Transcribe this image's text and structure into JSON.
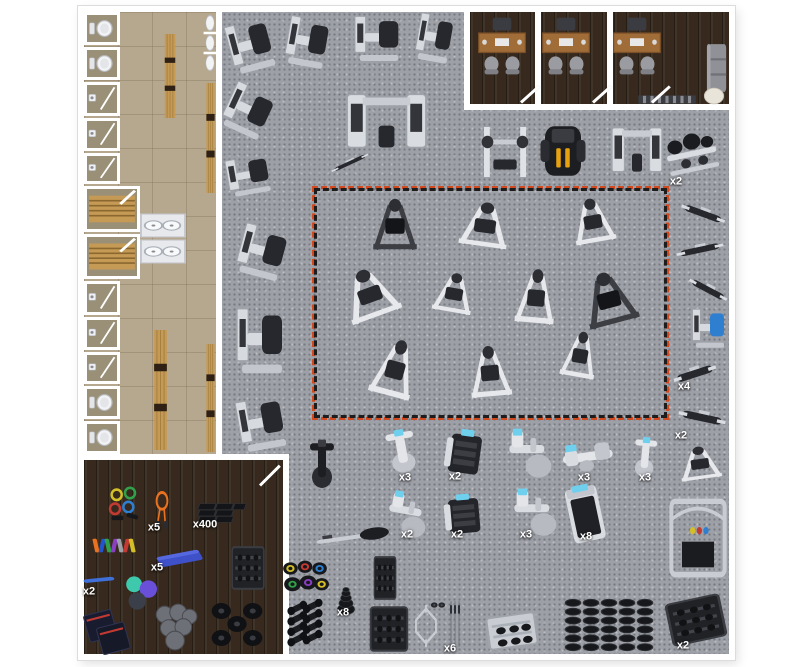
{
  "title": "gym-facility-floor-plan",
  "colors": {
    "wall": "#ffffff",
    "gym_floor": "#9da0a7",
    "locker_floor": "#b5a88e",
    "wood_floor": "#37291e",
    "red_dash": "#d14a1f",
    "red_dash_alt": "#1d1d1d",
    "label_text": "#ffffff",
    "machine_light": "#dfe2e7",
    "machine_dark": "#26282d",
    "cardio_screen_blue": "#6fd0ee",
    "bench_wood": "#c59a55",
    "rope_orange": "#e8721f",
    "yoga_mat_blue": "#3f51c9",
    "desk_wood": "#a06c38"
  },
  "locker": {
    "stalls": [
      {
        "name": "toilet-stall",
        "f": "toilet",
        "y": 12,
        "h": 33,
        "w": 36
      },
      {
        "name": "toilet-stall",
        "f": "toilet",
        "y": 47,
        "h": 33,
        "w": 36
      },
      {
        "name": "shower-stall",
        "f": "shower",
        "y": 82,
        "h": 34,
        "w": 36
      },
      {
        "name": "shower-stall",
        "f": "shower",
        "y": 118,
        "h": 33,
        "w": 36
      },
      {
        "name": "shower-stall",
        "f": "shower",
        "y": 153,
        "h": 31,
        "w": 36
      },
      {
        "name": "sauna-room",
        "f": "sauna",
        "y": 186,
        "h": 46,
        "w": 56
      },
      {
        "name": "sauna-room",
        "f": "sauna",
        "y": 234,
        "h": 45,
        "w": 56
      },
      {
        "name": "shower-stall",
        "f": "shower",
        "y": 281,
        "h": 34,
        "w": 36
      },
      {
        "name": "shower-stall",
        "f": "shower",
        "y": 317,
        "h": 33,
        "w": 36
      },
      {
        "name": "shower-stall",
        "f": "shower",
        "y": 352,
        "h": 32,
        "w": 36
      },
      {
        "name": "toilet-stall",
        "f": "toilet",
        "y": 386,
        "h": 33,
        "w": 36
      },
      {
        "name": "toilet-stall",
        "f": "toilet",
        "y": 421,
        "h": 33,
        "w": 36
      }
    ]
  },
  "fixtures": [
    {
      "name": "urinal-row",
      "type": "urinals",
      "x": 210,
      "y": 43,
      "w": 14,
      "h": 60
    },
    {
      "name": "locker-bench",
      "type": "woodbench",
      "x": 170,
      "y": 76,
      "w": 14,
      "h": 84
    },
    {
      "name": "locker-bench",
      "type": "woodbench",
      "x": 160,
      "y": 390,
      "w": 17,
      "h": 120
    },
    {
      "name": "wall-bench",
      "type": "woodbench",
      "x": 210,
      "y": 138,
      "w": 11,
      "h": 110
    },
    {
      "name": "wall-bench",
      "type": "woodbench",
      "x": 210,
      "y": 398,
      "w": 11,
      "h": 108
    },
    {
      "name": "sink-counter",
      "type": "sink",
      "x": 163,
      "y": 225,
      "w": 46,
      "h": 25
    },
    {
      "name": "sink-counter",
      "type": "sink",
      "x": 163,
      "y": 251,
      "w": 46,
      "h": 25
    },
    {
      "name": "office-desk-set",
      "type": "desk",
      "x": 502,
      "y": 46,
      "w": 56,
      "h": 62
    },
    {
      "name": "office-desk-set",
      "type": "desk",
      "x": 566,
      "y": 46,
      "w": 56,
      "h": 62
    },
    {
      "name": "office-desk-set",
      "type": "desk",
      "x": 637,
      "y": 46,
      "w": 56,
      "h": 62
    },
    {
      "name": "office-sofa",
      "type": "sofa",
      "x": 717,
      "y": 68,
      "w": 22,
      "h": 52
    },
    {
      "name": "office-round-table",
      "type": "roundtable",
      "x": 714,
      "y": 96,
      "w": 22,
      "h": 18
    },
    {
      "name": "radiator-vent",
      "type": "radiator",
      "x": 667,
      "y": 99,
      "w": 60,
      "h": 11
    }
  ],
  "equipment": [
    {
      "name": "pec-fly-machine",
      "type": "sel",
      "x": 252,
      "y": 45,
      "w": 54,
      "h": 64,
      "rot": -15
    },
    {
      "name": "leg-press-machine",
      "type": "sel",
      "x": 309,
      "y": 42,
      "w": 52,
      "h": 62,
      "rot": 10
    },
    {
      "name": "chest-press-machine",
      "type": "sel",
      "x": 379,
      "y": 38,
      "w": 58,
      "h": 58,
      "rot": 0
    },
    {
      "name": "lat-pulldown-tower",
      "type": "sel",
      "x": 436,
      "y": 38,
      "w": 44,
      "h": 60,
      "rot": 10
    },
    {
      "name": "leg-curl-machine",
      "type": "sel",
      "x": 250,
      "y": 111,
      "w": 56,
      "h": 60,
      "rot": 25
    },
    {
      "name": "multi-station-jungle",
      "type": "crossover",
      "x": 386,
      "y": 122,
      "w": 95,
      "h": 75,
      "rot": 0
    },
    {
      "name": "training-bench",
      "type": "bench",
      "x": 350,
      "y": 163,
      "w": 44,
      "h": 16,
      "rot": -25
    },
    {
      "name": "preacher-curl-machine",
      "type": "sel",
      "x": 250,
      "y": 175,
      "w": 54,
      "h": 48,
      "rot": -10
    },
    {
      "name": "shoulder-press-machine",
      "type": "sel",
      "x": 264,
      "y": 252,
      "w": 58,
      "h": 64,
      "rot": 15
    },
    {
      "name": "dip-chin-assist-tower",
      "type": "sel",
      "x": 262,
      "y": 340,
      "w": 60,
      "h": 84,
      "rot": 0
    },
    {
      "name": "glute-extension-machine",
      "type": "sel",
      "x": 263,
      "y": 423,
      "w": 58,
      "h": 66,
      "rot": -10
    },
    {
      "name": "smith-machine",
      "type": "smith",
      "x": 505,
      "y": 152,
      "w": 56,
      "h": 60,
      "rot": 0
    },
    {
      "name": "functional-trainer",
      "type": "darkft",
      "x": 563,
      "y": 151,
      "w": 54,
      "h": 66,
      "rot": 0
    },
    {
      "name": "cable-crossover-machine",
      "type": "crossover",
      "x": 637,
      "y": 151,
      "w": 60,
      "h": 62,
      "rot": 0
    },
    {
      "name": "barbell-plate-rack",
      "type": "rack2",
      "x": 692,
      "y": 155,
      "w": 60,
      "h": 55,
      "rot": -12,
      "label": "x2",
      "labelPos": [
        676,
        182
      ]
    },
    {
      "name": "preacher-bench",
      "type": "bench",
      "x": 703,
      "y": 214,
      "w": 50,
      "h": 28,
      "rot": 20
    },
    {
      "name": "hyperextension-bench",
      "type": "bench",
      "x": 700,
      "y": 250,
      "w": 52,
      "h": 26,
      "rot": -12
    },
    {
      "name": "ab-crunch-bench",
      "type": "bench",
      "x": 708,
      "y": 290,
      "w": 46,
      "h": 26,
      "rot": 28
    },
    {
      "name": "leg-raise-tower",
      "type": "sel",
      "x": 710,
      "y": 328,
      "w": 42,
      "h": 50,
      "rot": 0,
      "accent": "#2f7fd1"
    },
    {
      "name": "adjustable-bench",
      "type": "bench",
      "x": 695,
      "y": 374,
      "w": 48,
      "h": 32,
      "rot": -18,
      "label": "x4",
      "labelPos": [
        684,
        387
      ]
    },
    {
      "name": "flat-bench",
      "type": "bench",
      "x": 702,
      "y": 418,
      "w": 52,
      "h": 32,
      "rot": 12,
      "label": "x2",
      "labelPos": [
        681,
        436
      ]
    },
    {
      "name": "bench-press-station",
      "type": "plate",
      "x": 700,
      "y": 464,
      "w": 54,
      "h": 40,
      "rot": -8
    },
    {
      "name": "v-squat-machine",
      "type": "plate",
      "x": 395,
      "y": 226,
      "w": 58,
      "h": 62,
      "rot": 0,
      "dark": true
    },
    {
      "name": "glute-ham-machine",
      "type": "plate",
      "x": 485,
      "y": 226,
      "w": 64,
      "h": 54,
      "rot": 8
    },
    {
      "name": "t-bar-row-machine",
      "type": "plate",
      "x": 593,
      "y": 222,
      "w": 54,
      "h": 54,
      "rot": -10
    },
    {
      "name": "linear-leg-press",
      "type": "plate",
      "x": 370,
      "y": 295,
      "w": 70,
      "h": 60,
      "rot": -20
    },
    {
      "name": "iso-lateral-press",
      "type": "plate",
      "x": 454,
      "y": 294,
      "w": 52,
      "h": 48,
      "rot": 10
    },
    {
      "name": "seated-dip-machine",
      "type": "plate",
      "x": 536,
      "y": 298,
      "w": 52,
      "h": 66,
      "rot": 5
    },
    {
      "name": "hack-squat-machine",
      "type": "plate",
      "x": 609,
      "y": 300,
      "w": 68,
      "h": 64,
      "rot": -15,
      "dark": true
    },
    {
      "name": "incline-press-machine",
      "type": "plate",
      "x": 395,
      "y": 370,
      "w": 56,
      "h": 70,
      "rot": 15
    },
    {
      "name": "seated-row-machine",
      "type": "plate",
      "x": 490,
      "y": 373,
      "w": 54,
      "h": 62,
      "rot": -5
    },
    {
      "name": "glute-kickback-machine",
      "type": "plate",
      "x": 580,
      "y": 356,
      "w": 46,
      "h": 56,
      "rot": 10
    },
    {
      "name": "air-bike",
      "type": "bike",
      "x": 322,
      "y": 465,
      "w": 48,
      "h": 58,
      "rot": 0,
      "dark": true
    },
    {
      "name": "spin-bike",
      "type": "bike",
      "x": 402,
      "y": 452,
      "w": 56,
      "h": 52,
      "rot": -10,
      "label": "x3",
      "labelPos": [
        405,
        478
      ]
    },
    {
      "name": "stair-climber",
      "type": "climber",
      "x": 465,
      "y": 453,
      "w": 52,
      "h": 54,
      "rot": 8,
      "label": "x2",
      "labelPos": [
        455,
        477
      ]
    },
    {
      "name": "elliptical-trainer",
      "type": "elliptical",
      "x": 528,
      "y": 452,
      "w": 56,
      "h": 56,
      "rot": 0
    },
    {
      "name": "recumbent-bike",
      "type": "recumbent",
      "x": 588,
      "y": 458,
      "w": 60,
      "h": 46,
      "rot": -8,
      "label": "x3",
      "labelPos": [
        584,
        478
      ]
    },
    {
      "name": "upright-bike",
      "type": "bike",
      "x": 645,
      "y": 458,
      "w": 44,
      "h": 48,
      "rot": 5,
      "label": "x3",
      "labelPos": [
        645,
        478
      ]
    },
    {
      "name": "rowing-machine",
      "type": "rower",
      "x": 352,
      "y": 538,
      "w": 78,
      "h": 32,
      "rot": -8
    },
    {
      "name": "compact-elliptical",
      "type": "elliptical",
      "x": 406,
      "y": 513,
      "w": 52,
      "h": 50,
      "rot": 10,
      "label": "x2",
      "labelPos": [
        407,
        535
      ]
    },
    {
      "name": "seated-stepper",
      "type": "climber",
      "x": 464,
      "y": 515,
      "w": 52,
      "h": 48,
      "rot": -5,
      "label": "x2",
      "labelPos": [
        457,
        535
      ]
    },
    {
      "name": "elliptical-trainer-2",
      "type": "elliptical",
      "x": 533,
      "y": 511,
      "w": 56,
      "h": 54,
      "rot": 0,
      "label": "x3",
      "labelPos": [
        526,
        535
      ]
    },
    {
      "name": "treadmill",
      "type": "treadmill",
      "x": 585,
      "y": 513,
      "w": 48,
      "h": 62,
      "rot": -12,
      "label": "x8",
      "labelPos": [
        586,
        537
      ]
    },
    {
      "name": "functional-rig-platform",
      "type": "rig",
      "x": 698,
      "y": 538,
      "w": 64,
      "h": 88,
      "rot": 0
    },
    {
      "name": "kettlebell-set",
      "type": "kbs",
      "x": 305,
      "y": 579,
      "w": 50,
      "h": 42,
      "rot": 0
    },
    {
      "name": "dumbbell-pairs",
      "type": "dbrow",
      "x": 306,
      "y": 624,
      "w": 46,
      "h": 50,
      "rot": 0
    },
    {
      "name": "weight-plate-stack",
      "type": "plates",
      "x": 346,
      "y": 598,
      "w": 26,
      "h": 36,
      "rot": 0,
      "label": "x8",
      "labelPos": [
        343,
        613
      ]
    },
    {
      "name": "plate-tree",
      "type": "rackdark",
      "x": 385,
      "y": 578,
      "w": 26,
      "h": 50,
      "rot": 0
    },
    {
      "name": "kettlebell-rack",
      "type": "rackdark",
      "x": 389,
      "y": 629,
      "w": 44,
      "h": 52,
      "rot": 0
    },
    {
      "name": "hex-trap-bar",
      "type": "hexbar",
      "x": 426,
      "y": 626,
      "w": 30,
      "h": 46,
      "rot": 0
    },
    {
      "name": "barbell-collars",
      "type": "collars",
      "x": 438,
      "y": 605,
      "w": 18,
      "h": 14,
      "rot": 0
    },
    {
      "name": "barbell-set",
      "type": "bars",
      "x": 455,
      "y": 624,
      "w": 16,
      "h": 50,
      "rot": 0,
      "label": "x6",
      "labelPos": [
        450,
        649
      ]
    },
    {
      "name": "storage-shelf",
      "type": "racksilver",
      "x": 512,
      "y": 631,
      "w": 58,
      "h": 42,
      "rot": -8
    },
    {
      "name": "dumbbell-columns",
      "type": "dbcols",
      "x": 609,
      "y": 625,
      "w": 96,
      "h": 56,
      "rot": 0
    },
    {
      "name": "dumbbell-rack-2tier",
      "type": "rackdark",
      "x": 696,
      "y": 620,
      "w": 64,
      "h": 50,
      "rot": -12,
      "label": "x2",
      "labelPos": [
        683,
        646
      ]
    },
    {
      "name": "resistance-band-set",
      "type": "bands",
      "x": 125,
      "y": 507,
      "w": 40,
      "h": 42,
      "rot": 0
    },
    {
      "name": "jump-ropes",
      "type": "ropes",
      "x": 162,
      "y": 510,
      "w": 26,
      "h": 40,
      "rot": 0,
      "label": "x5",
      "labelPos": [
        154,
        528
      ]
    },
    {
      "name": "rubber-floor-tiles",
      "type": "mats",
      "x": 220,
      "y": 513,
      "w": 56,
      "h": 28,
      "rot": 0,
      "label": "x400",
      "labelPos": [
        205,
        525
      ]
    },
    {
      "name": "mini-band-set",
      "type": "minibands",
      "x": 114,
      "y": 546,
      "w": 46,
      "h": 22,
      "rot": 0
    },
    {
      "name": "yoga-mats",
      "type": "mat",
      "x": 180,
      "y": 559,
      "w": 48,
      "h": 28,
      "rot": 0,
      "label": "x5",
      "labelPos": [
        157,
        568
      ]
    },
    {
      "name": "storage-rack-black",
      "type": "rackdark",
      "x": 248,
      "y": 568,
      "w": 38,
      "h": 50,
      "rot": 0
    },
    {
      "name": "foam-roller",
      "type": "roller",
      "x": 99,
      "y": 580,
      "w": 34,
      "h": 16,
      "rot": 0,
      "label": "x2",
      "labelPos": [
        89,
        592
      ]
    },
    {
      "name": "stability-balls",
      "type": "balls",
      "x": 142,
      "y": 593,
      "w": 38,
      "h": 38,
      "rot": 0
    },
    {
      "name": "plyo-boxes",
      "type": "plyo",
      "x": 108,
      "y": 631,
      "w": 52,
      "h": 50,
      "rot": 0
    },
    {
      "name": "medicine-ball-set",
      "type": "medballs",
      "x": 175,
      "y": 627,
      "w": 50,
      "h": 50,
      "rot": 0
    },
    {
      "name": "slam-balls",
      "type": "slamballs",
      "x": 237,
      "y": 624,
      "w": 58,
      "h": 48,
      "rot": 0
    }
  ],
  "doors": [
    {
      "name": "office-door",
      "x": 521,
      "y": 101,
      "len": 24,
      "rot": -42
    },
    {
      "name": "office-door",
      "x": 593,
      "y": 101,
      "len": 24,
      "rot": -42
    },
    {
      "name": "office-door",
      "x": 652,
      "y": 101,
      "len": 24,
      "rot": -42
    },
    {
      "name": "accessories-door",
      "x": 260,
      "y": 484,
      "len": 28,
      "rot": -45
    }
  ]
}
